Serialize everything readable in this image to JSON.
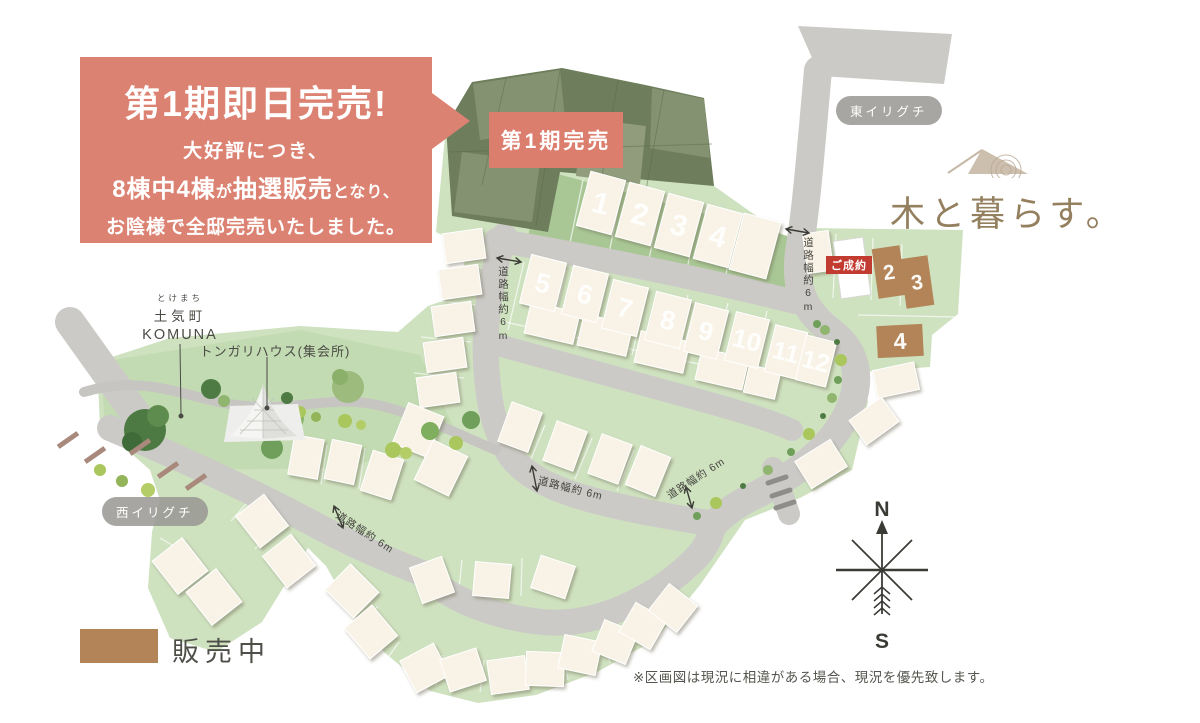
{
  "callout": {
    "title": "第1期即日完売!",
    "line1": "大好評につき、",
    "line2_a": "8棟中4棟",
    "line2_b": "が",
    "line2_c": "抽選販売",
    "line2_d": "となり、",
    "line3": "お陰様で全邸完売いたしました。"
  },
  "map_labels": {
    "phase1_sold": "第1期完売",
    "east_entrance": "東イリグチ",
    "west_entrance": "西イリグチ",
    "contracted": "ご成約",
    "town_furigana": "とけまち",
    "town_name": "土気町",
    "town_sub": "KOMUNA",
    "meeting_house": "トンガリハウス(集会所)",
    "road_width": "道路幅約6m",
    "road_width_spaced": "道路幅約 6m"
  },
  "lots": {
    "phase2_numbers": [
      "1",
      "2",
      "3",
      "4",
      "5",
      "6",
      "7",
      "8",
      "9",
      "10",
      "11",
      "12"
    ],
    "for_sale_numbers": [
      "2",
      "3",
      "4"
    ]
  },
  "logo": {
    "text": "木と暮らす。"
  },
  "legend": {
    "label": "販売中",
    "color": "#b28457"
  },
  "compass": {
    "north": "N",
    "south": "S"
  },
  "disclaimer": "※区画図は現況に相違がある場合、現況を優先致します。",
  "colors": {
    "accent_salmon": "#dc8272",
    "sold_dark_green": "#6e7d5c",
    "lot_green": "#cfe2c0",
    "band_green": "#a9c795",
    "road_gray": "#cbcac6",
    "for_sale_brown": "#b28457",
    "contracted_red": "#c23b30",
    "logo_brown": "#94805f",
    "text_dark": "#4b4b46"
  }
}
